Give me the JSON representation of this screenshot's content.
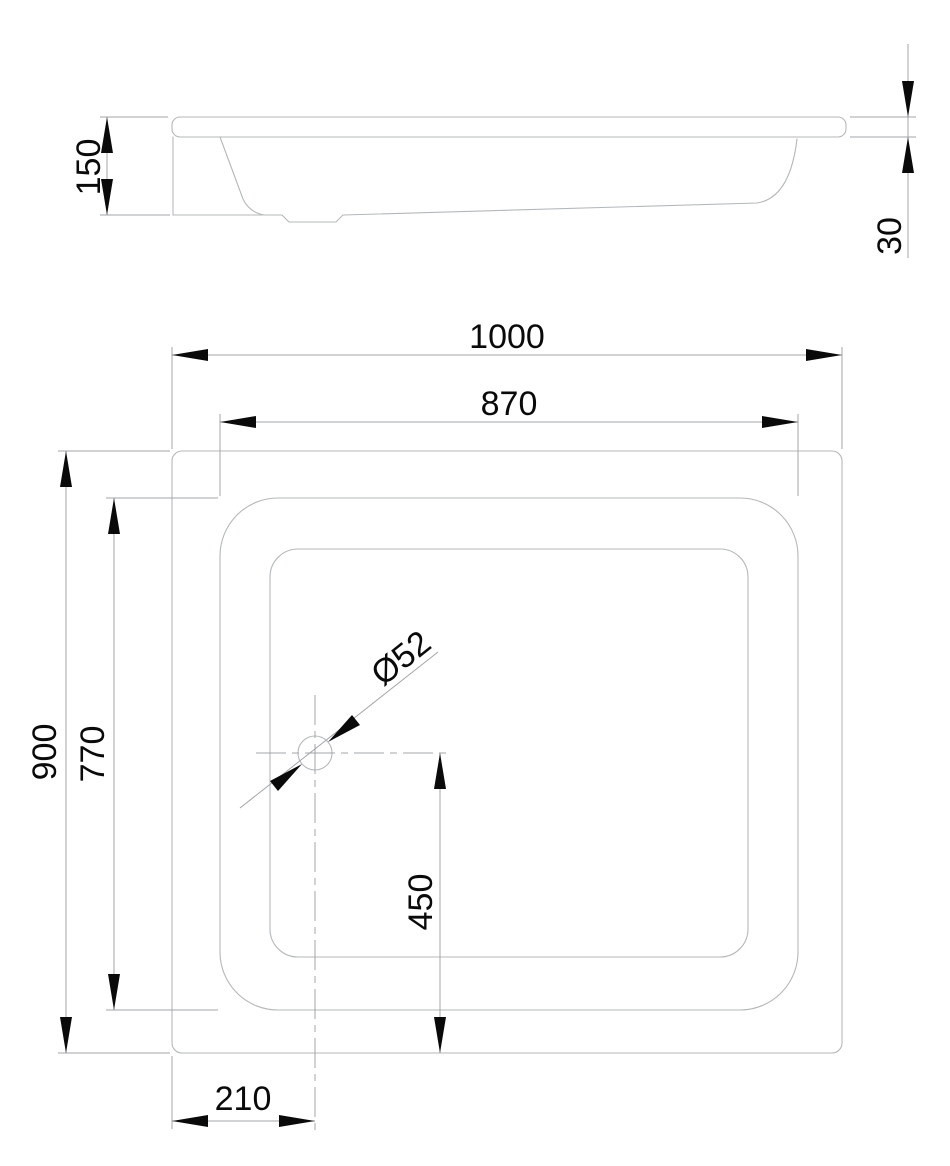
{
  "drawing": {
    "colors": {
      "background": "#ffffff",
      "outline_line": "#b4b8ba",
      "dimension_line": "#a2a6a8",
      "annotation": "#0a0a0a"
    },
    "dims": {
      "overall_width": "1000",
      "inner_width": "870",
      "overall_depth": "900",
      "inner_depth": "770",
      "tray_height": "150",
      "rim_thickness": "30",
      "drain_from_left": "210",
      "drain_from_bottom": "450",
      "drain_diameter": "Ø52"
    }
  }
}
